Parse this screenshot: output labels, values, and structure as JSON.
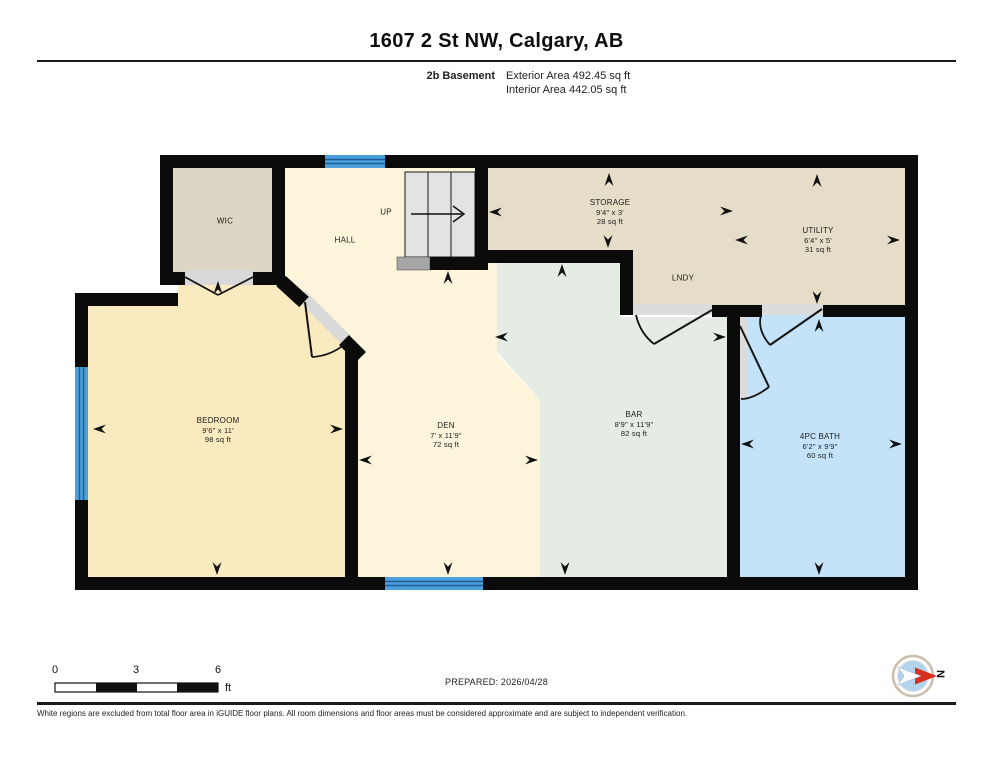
{
  "header": {
    "title": "1607 2 St NW, Calgary, AB",
    "floor_label": "2b Basement",
    "exterior_area": "Exterior Area 492.45 sq ft",
    "interior_area": "Interior Area 442.05 sq ft"
  },
  "rooms": {
    "wic": {
      "name": "WIC"
    },
    "hall": {
      "name": "HALL"
    },
    "stairs": {
      "label": "UP"
    },
    "storage": {
      "name": "STORAGE",
      "dims": "9'4\" x 3'",
      "area": "28 sq ft"
    },
    "utility": {
      "name": "UTILITY",
      "dims": "6'4\" x 5'",
      "area": "31 sq ft"
    },
    "laundry": {
      "name": "LNDY"
    },
    "bedroom": {
      "name": "BEDROOM",
      "dims": "9'6\" x 11'",
      "area": "98 sq ft"
    },
    "den": {
      "name": "DEN",
      "dims": "7' x 11'9\"",
      "area": "72 sq ft"
    },
    "bar": {
      "name": "BAR",
      "dims": "8'9\" x 11'9\"",
      "area": "82 sq ft"
    },
    "bath": {
      "name": "4PC BATH",
      "dims": "6'2\" x 9'9\"",
      "area": "60 sq ft"
    }
  },
  "scale_bar": {
    "labels": [
      "0",
      "3",
      "6"
    ],
    "unit": "ft"
  },
  "prepared": "PREPARED: 2026/04/28",
  "compass": {
    "label": "N"
  },
  "footer": "White regions are excluded from total floor area in iGUIDE floor plans. All room dimensions and floor areas must be considered approximate and are subject to independent verification.",
  "colors": {
    "wall": "#0b0b0b",
    "wic": "#DDD6C5",
    "hall_den": "#FCF5DC",
    "storage_area": "#E5DDC7",
    "bedroom": "#FAEAC0",
    "bar": "#E4ECE3",
    "bath": "#C5E3F8",
    "window": "#4D9FD9",
    "stairs": "#E3E3E3"
  }
}
